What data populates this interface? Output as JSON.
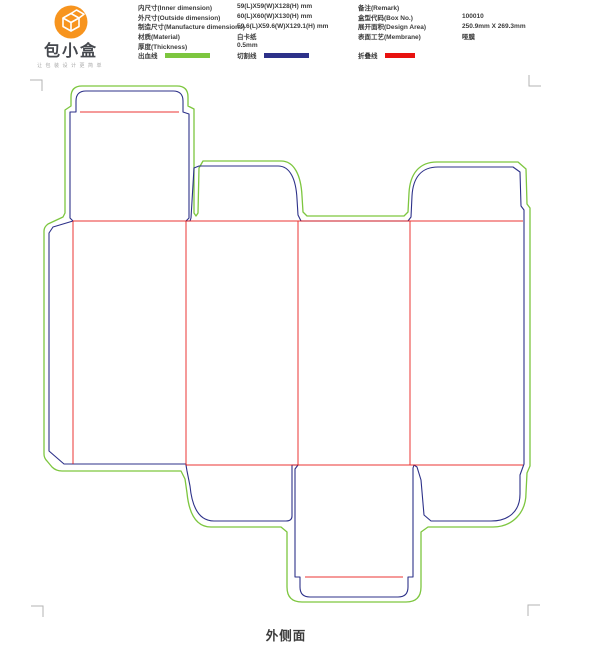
{
  "header": {
    "logo": {
      "title": "包小盒",
      "tagline": "让包装设计更简单"
    },
    "specs_left": [
      {
        "label": "内尺寸(Inner dimension)",
        "value": "59(L)X59(W)X128(H) mm"
      },
      {
        "label": "外尺寸(Outside dimension)",
        "value": "60(L)X60(W)X130(H) mm"
      },
      {
        "label": "制造尺寸(Manufacture dimensions)",
        "value": "59.6(L)X59.6(W)X129.1(H) mm"
      },
      {
        "label": "材质(Material)",
        "value": "白卡纸"
      },
      {
        "label": "厚度(Thickness)",
        "value": "0.5mm"
      }
    ],
    "specs_right": [
      {
        "label": "备注(Remark)",
        "value": ""
      },
      {
        "label": "盒型代码(Box No.)",
        "value": "100010"
      },
      {
        "label": "展开面积(Design Area)",
        "value": "250.9mm X 269.3mm"
      },
      {
        "label": "表面工艺(Membrane)",
        "value": "哑膜"
      }
    ],
    "legend": [
      {
        "label": "出血线",
        "color": "#7DC63F",
        "type": "bleed"
      },
      {
        "label": "切割线",
        "color": "#2D3189",
        "type": "cut"
      },
      {
        "label": "折叠线",
        "color": "#E8120F",
        "type": "fold"
      }
    ]
  },
  "footer": {
    "label": "外侧面"
  },
  "colors": {
    "logo_orange": "#F7941E",
    "logo_glyph": "#FFFFFF",
    "corner_mark": "#B3B3B3"
  }
}
